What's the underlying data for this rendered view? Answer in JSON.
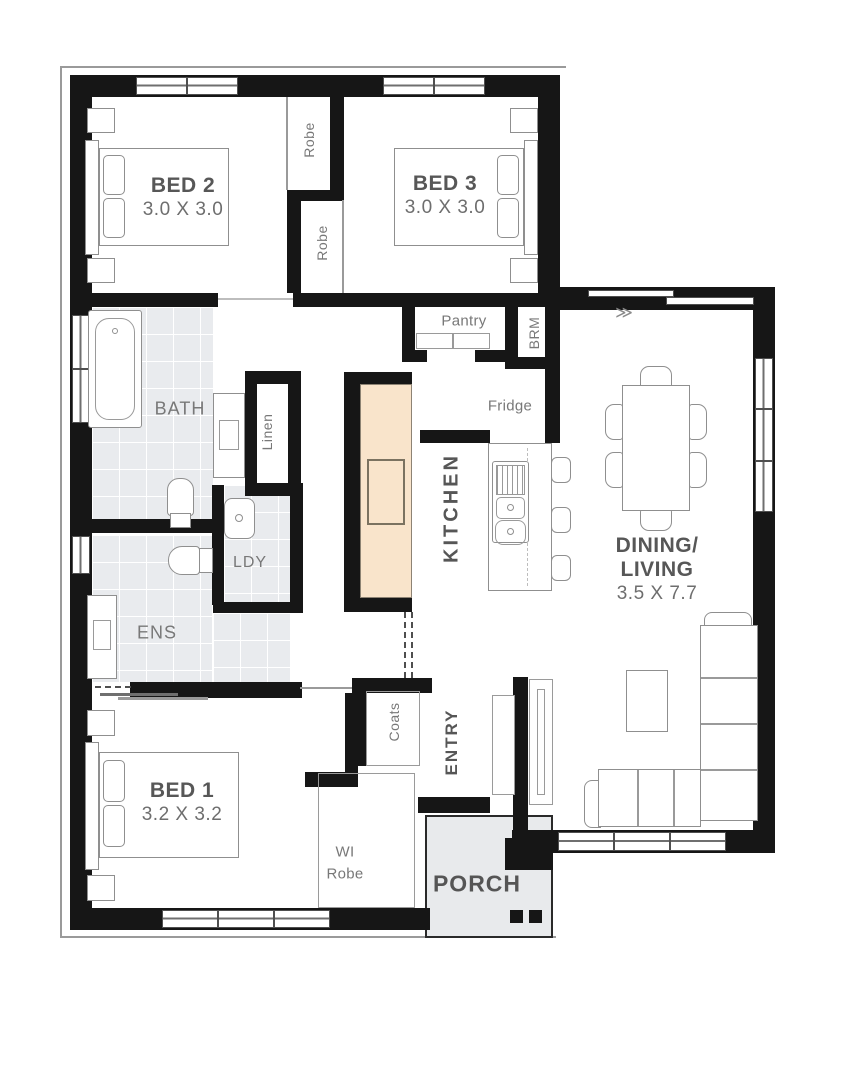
{
  "rooms": {
    "bed2": {
      "label": "BED 2",
      "dims": "3.0 X 3.0"
    },
    "bed3": {
      "label": "BED 3",
      "dims": "3.0 X 3.0"
    },
    "bed1": {
      "label": "BED 1",
      "dims": "3.2 X 3.2"
    },
    "dining": {
      "label1": "DINING/",
      "label2": "LIVING",
      "dims": "3.5 X 7.7"
    },
    "kitchen": {
      "label": "KITCHEN"
    },
    "entry": {
      "label": "ENTRY"
    },
    "porch": {
      "label": "PORCH"
    },
    "bath": {
      "label": "BATH"
    },
    "ens": {
      "label": "ENS"
    },
    "ldy": {
      "label": "LDY"
    },
    "linen": {
      "label": "Linen"
    },
    "pantry": {
      "label": "Pantry"
    },
    "brm": {
      "label": "BRM"
    },
    "fridge": {
      "label": "Fridge"
    },
    "robe_top": {
      "label": "Robe"
    },
    "robe_bottom": {
      "label": "Robe"
    },
    "wi_robe": {
      "label1": "WI",
      "label2": "Robe"
    },
    "coats": {
      "label": "Coats"
    }
  },
  "icons": {
    "slide_arrow": "≫"
  },
  "colors": {
    "wall": "#161616",
    "tile": "#e9ebee",
    "bench": "#f9e4cb",
    "porch": "#e8eaec",
    "label": "#6e6e6e"
  }
}
